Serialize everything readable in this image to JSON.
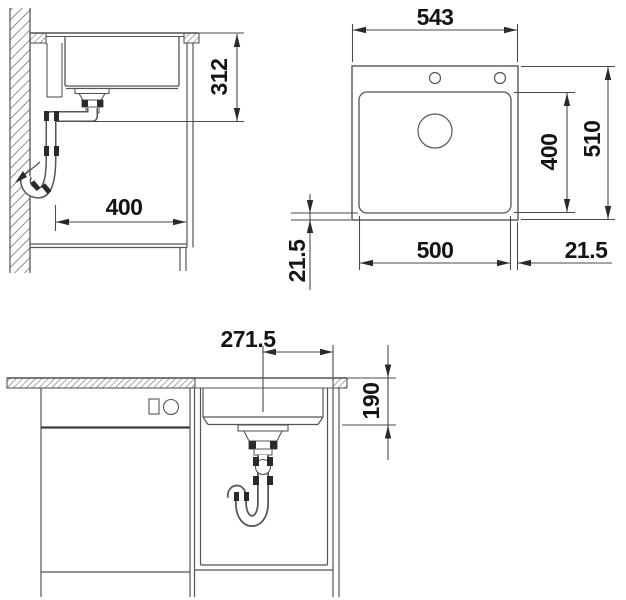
{
  "colors": {
    "line": "#555555",
    "clamp_dark": "#2a2a2a",
    "text": "#141414",
    "background": "#ffffff"
  },
  "views": {
    "side": {
      "dim_height": "312",
      "dim_width": "400"
    },
    "plan": {
      "dim_outer_width": "543",
      "dim_outer_depth": "510",
      "dim_bowl_depth": "400",
      "dim_bowl_width": "500",
      "dim_rim_side": "21.5",
      "dim_rim_front": "21.5"
    },
    "front": {
      "dim_center_offset": "271.5",
      "dim_bowl_height": "190"
    }
  }
}
